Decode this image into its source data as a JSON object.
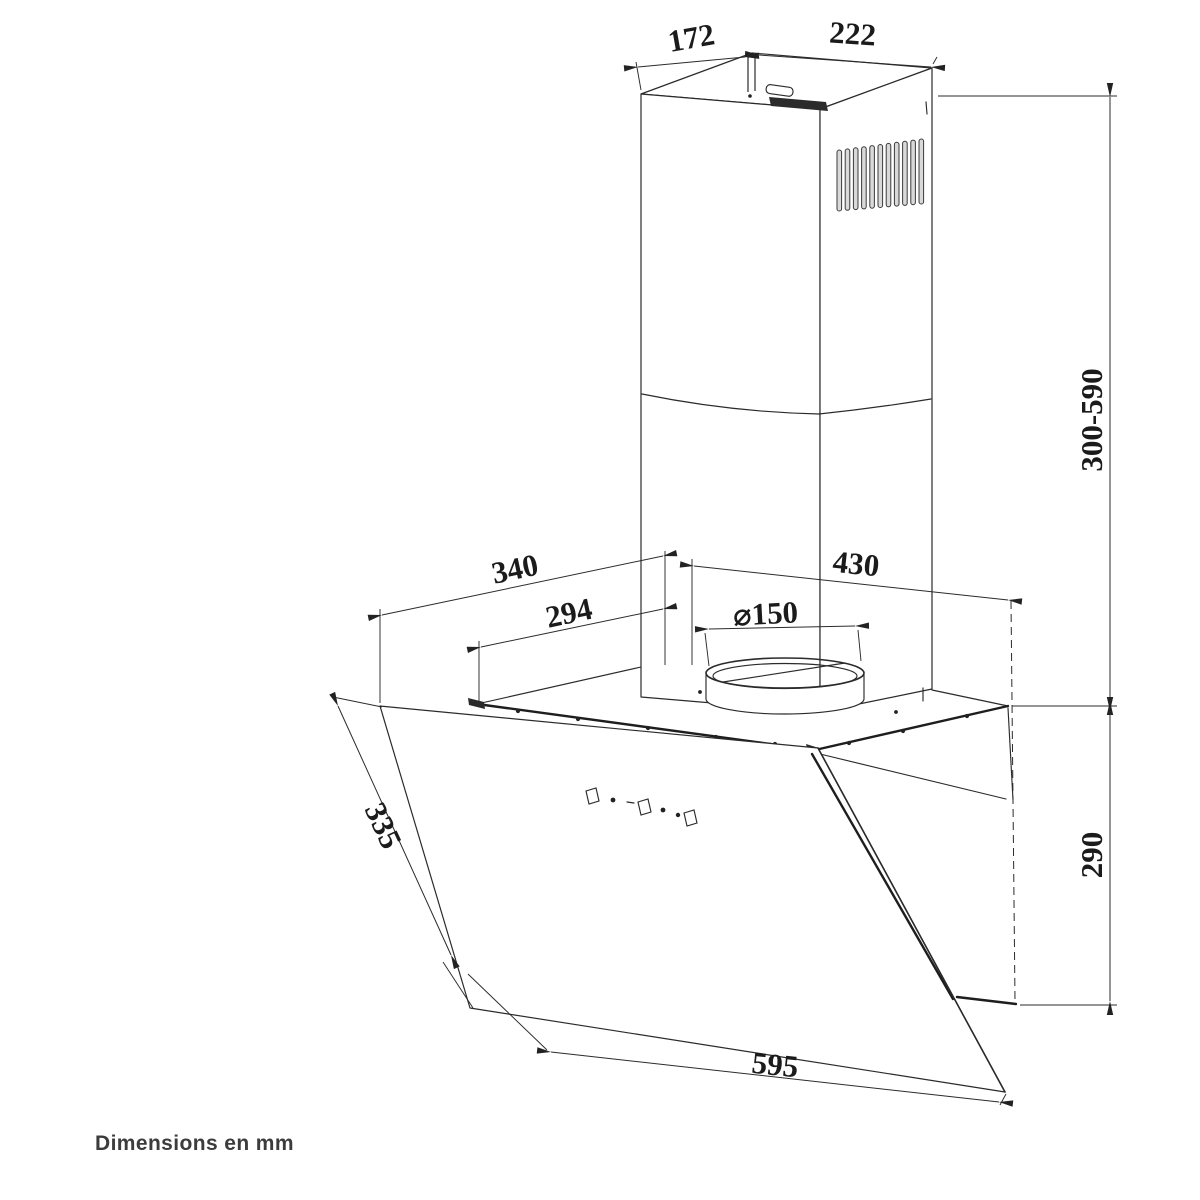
{
  "diagram": {
    "title": "Cooker hood technical line drawing",
    "note": "Dimensions en mm",
    "dimensions": {
      "top_duct_depth": "172",
      "top_duct_width": "222",
      "chimney_height": "300-590",
      "body_height": "290",
      "hood_top_depth": "340",
      "filter_depth": "294",
      "outlet_diameter": "⌀150",
      "hood_top_width": "430",
      "glass_panel_depth": "335",
      "glass_panel_width": "595"
    },
    "colors": {
      "line": "#2b2b2b",
      "label": "#1b1b1b",
      "note": "#3c3c3c",
      "background": "#ffffff",
      "slat_fill": "#d9d9d9"
    }
  }
}
